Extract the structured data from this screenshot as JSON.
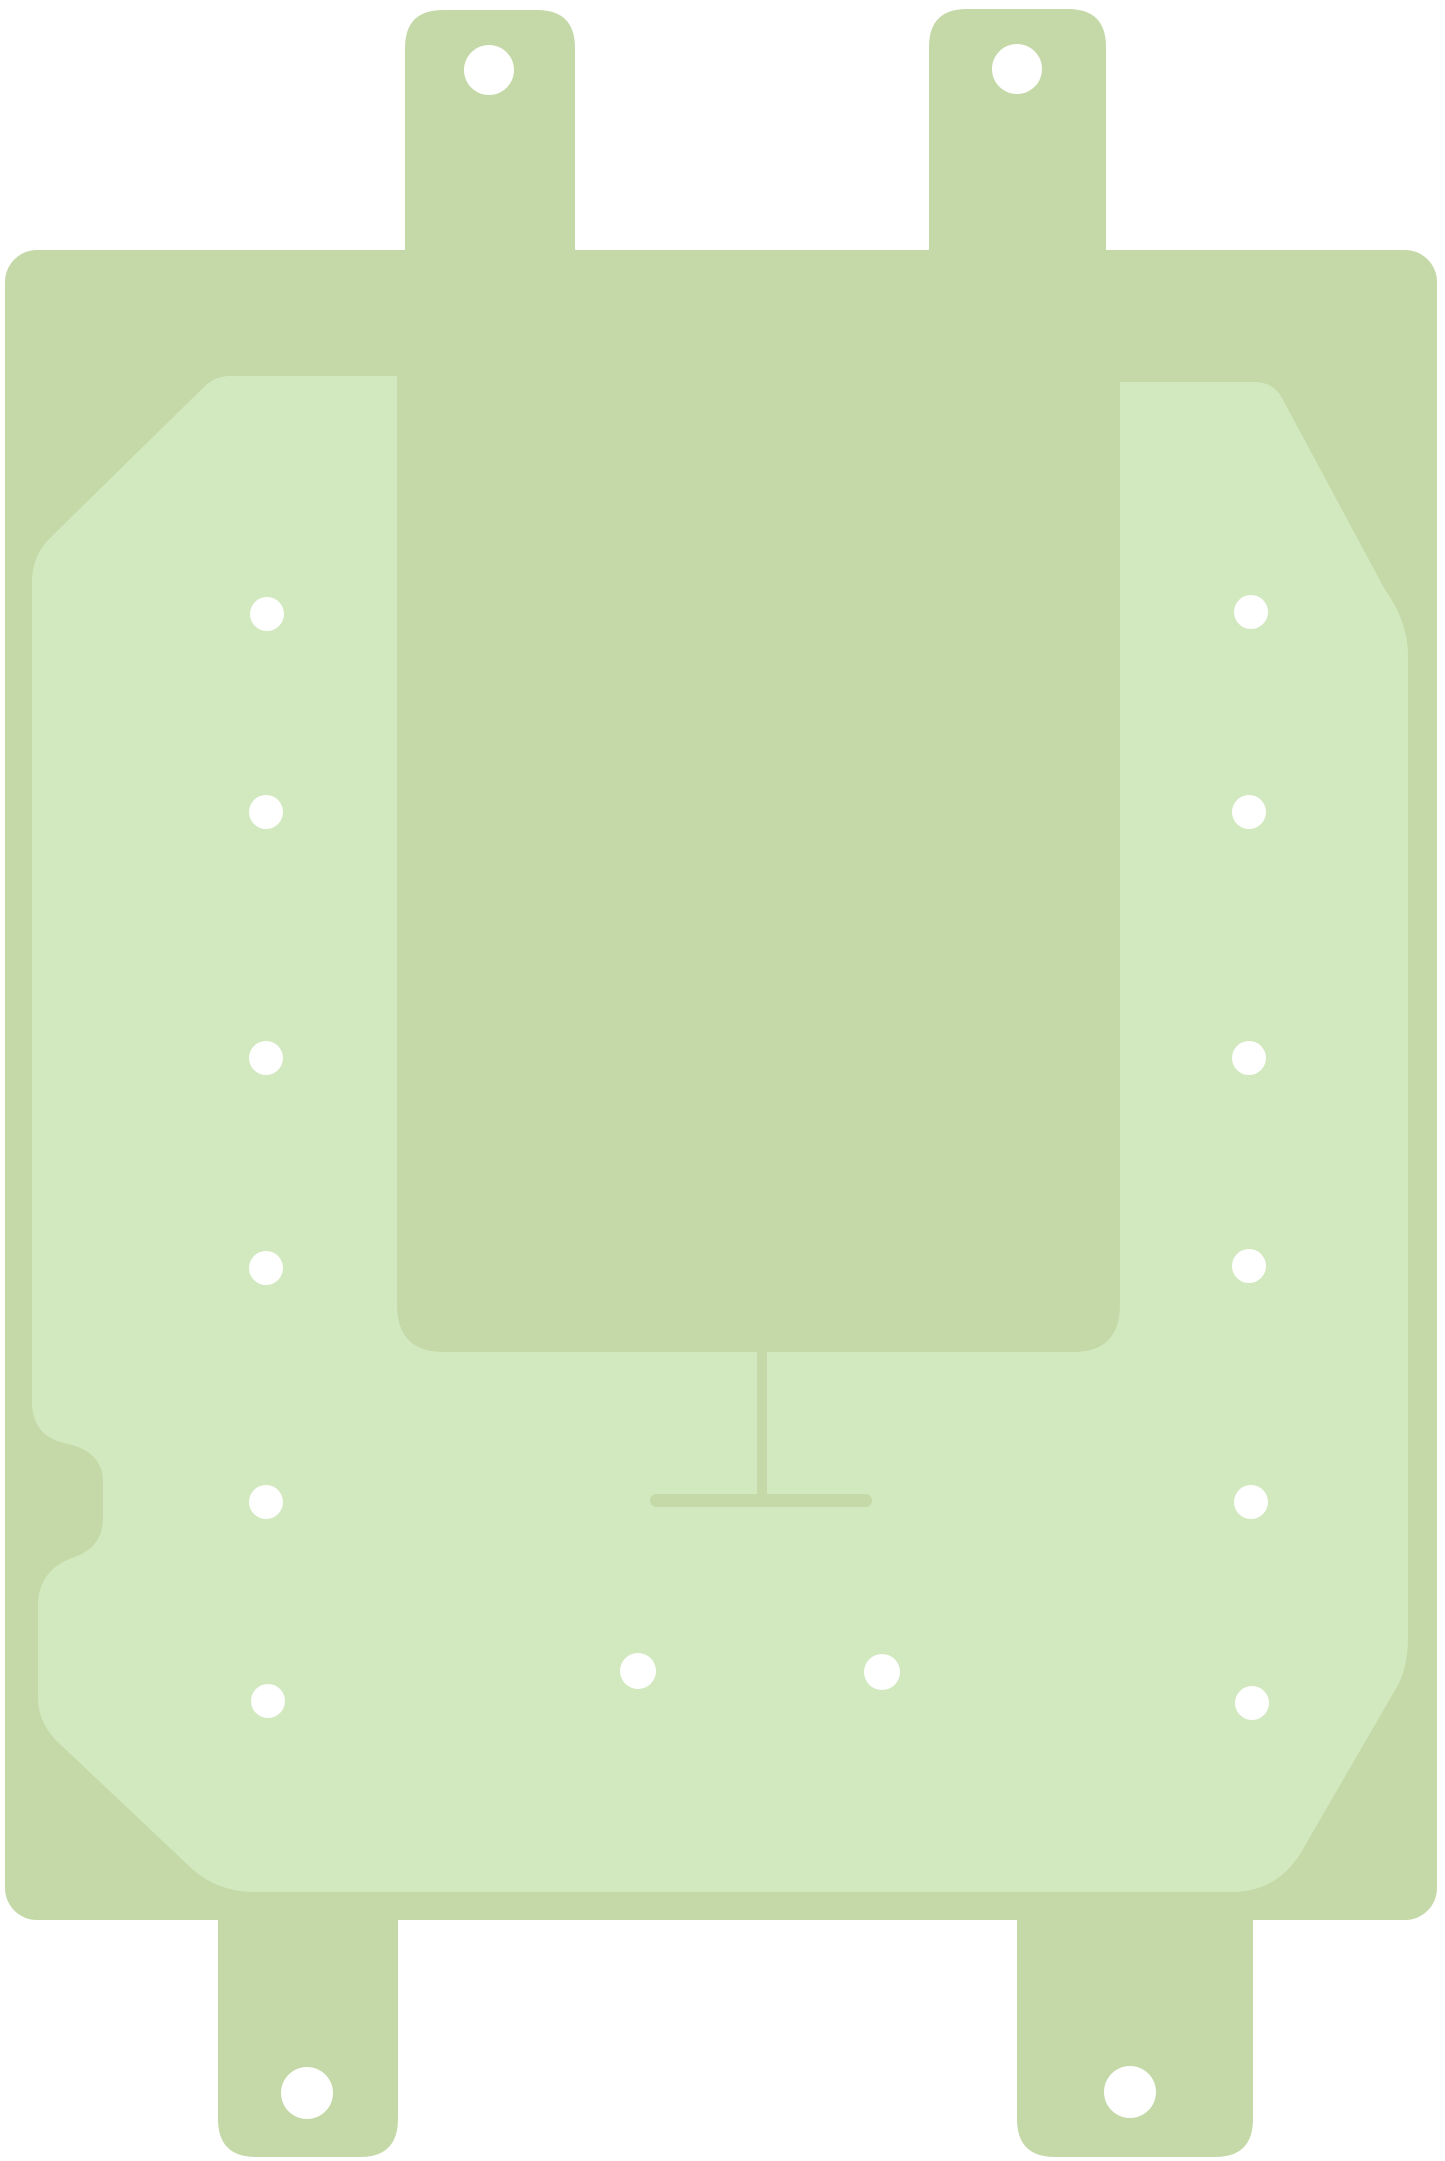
{
  "canvas": {
    "width": 1445,
    "height": 2161,
    "background_color": "#ffffff"
  },
  "subject": {
    "description": "adhesive-gasket-sticker",
    "colors": {
      "sheet": "#c5d9a8",
      "liner": "#d2e9c0",
      "hole": "#ffffff"
    }
  },
  "shapes": {
    "sheet_body": {
      "x": 5,
      "y": 250,
      "width": 1432,
      "height": 1670,
      "rx": 32
    },
    "top_tabs": [
      {
        "path": "M405 292 L405 48 Q405 10 443 10 L537 10 Q575 10 575 48 L575 292 Z"
      },
      {
        "path": "M929 292 L929 47 Q929 9 967 9 L1068 9 Q1106 9 1106 47 L1106 292 Z"
      }
    ],
    "bottom_tabs": [
      {
        "path": "M218 1878 L218 2119 Q218 2157 256 2157 L360 2157 Q398 2157 398 2119 L398 1878 Z"
      },
      {
        "path": "M1017 1878 L1017 2119 Q1017 2157 1055 2157 L1215 2157 Q1253 2157 1253 2119 L1253 1878 Z"
      }
    ],
    "liner_cutout": {
      "path": "M230 376 L397 376 L397 1305 Q397 1352 444 1352 L1073 1352 Q1120 1352 1120 1305 L1120 382 L1256 382 Q1274 383 1282 398 L1384 588 Q1408 622 1408 655 L1408 1638 Q1408 1670 1394 1692 L1307 1842 Q1282 1892 1232 1892 L255 1892 Q216 1892 189 1866 L62 1746 Q38 1725 38 1698 L38 1602 Q40 1570 72 1558 Q103 1548 103 1518 L103 1482 Q103 1452 68 1444 Q32 1437 32 1402 L32 582 Q32 556 50 538 L203 388 Q214 376 230 376 Z"
    },
    "t_mark": {
      "vertical_bar": {
        "x": 757,
        "y": 1350,
        "width": 10,
        "height": 152,
        "rx": 4
      },
      "horizontal_bar": {
        "x": 650,
        "y": 1494,
        "width": 222,
        "height": 13,
        "rx": 6.5
      }
    },
    "tab_holes": [
      {
        "cx": 489,
        "cy": 70,
        "r": 25
      },
      {
        "cx": 1017,
        "cy": 69,
        "r": 25
      },
      {
        "cx": 307,
        "cy": 2093,
        "r": 26
      },
      {
        "cx": 1130,
        "cy": 2092,
        "r": 26
      }
    ],
    "liner_holes_left_column": [
      {
        "cx": 267,
        "cy": 614,
        "r": 17
      },
      {
        "cx": 266,
        "cy": 812,
        "r": 17
      },
      {
        "cx": 266,
        "cy": 1058,
        "r": 17
      },
      {
        "cx": 266,
        "cy": 1268,
        "r": 17
      },
      {
        "cx": 266,
        "cy": 1502,
        "r": 17
      },
      {
        "cx": 268,
        "cy": 1701,
        "r": 17
      }
    ],
    "liner_holes_right_column": [
      {
        "cx": 1251,
        "cy": 612,
        "r": 17
      },
      {
        "cx": 1249,
        "cy": 812,
        "r": 17
      },
      {
        "cx": 1249,
        "cy": 1058,
        "r": 17
      },
      {
        "cx": 1249,
        "cy": 1266,
        "r": 17
      },
      {
        "cx": 1251,
        "cy": 1502,
        "r": 17
      },
      {
        "cx": 1252,
        "cy": 1703,
        "r": 17
      }
    ],
    "liner_holes_bottom": [
      {
        "cx": 638,
        "cy": 1671,
        "r": 18
      },
      {
        "cx": 882,
        "cy": 1672,
        "r": 18
      }
    ]
  }
}
